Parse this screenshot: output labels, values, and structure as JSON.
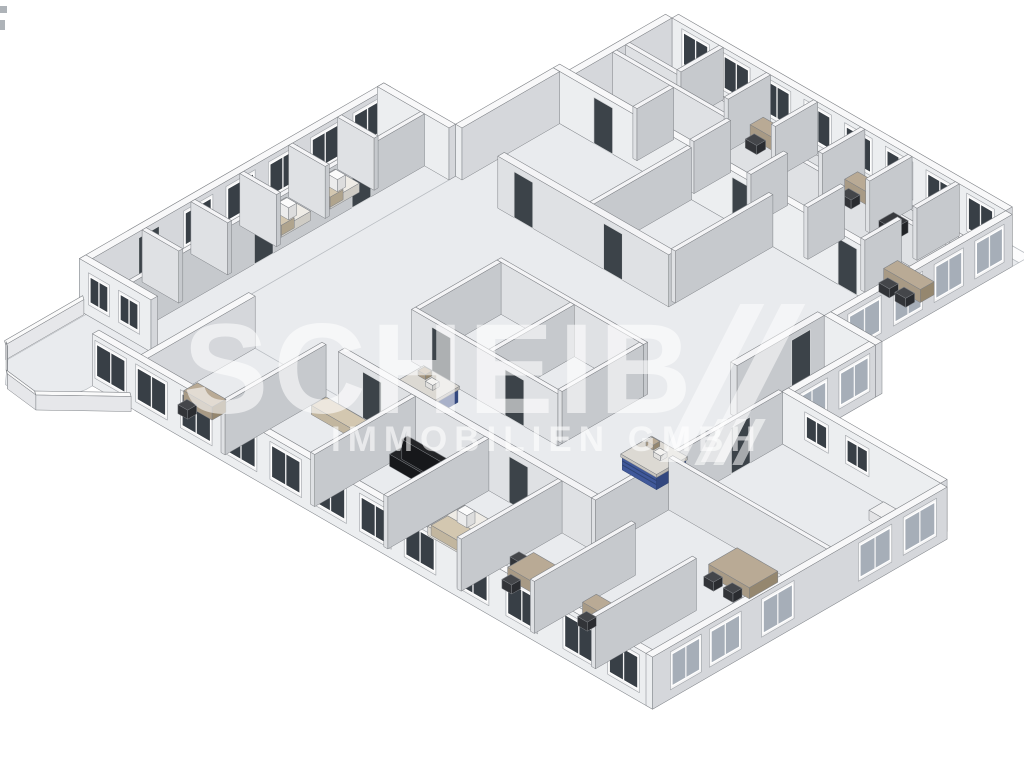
{
  "watermark": {
    "line1": "SCHEIB",
    "line2": "IMMOBILIEN GMBH"
  },
  "palette": {
    "bg": "#ffffff",
    "floor": "#e9ebee",
    "floorStroke": "#b9bdc2",
    "slab": "#fcfcfd",
    "wallTopExt": "#f8f8f9",
    "wallSWExt": "#eceef0",
    "wallSEExt": "#d5d7db",
    "wallTopInt": "#f4f4f6",
    "wallSWInt": "#dfe1e4",
    "wallSEInt": "#c6c9cd",
    "wallStroke": "#7d8085",
    "glassDark": "#383f46",
    "glassLite": "#a6aeb8",
    "frame": "#f4f4f5",
    "frameStroke": "#9fa3a8",
    "door": "#3c4349",
    "doorStroke": "#d7d9db",
    "beigeTop": "#b9aa95",
    "beigeSW": "#a89a85",
    "beigeSE": "#95876f",
    "chairTop": "#44464a",
    "chairSW": "#323438",
    "chairSE": "#2a2c30",
    "whiteTop": "#f1f1f2",
    "whiteSW": "#e4e4e6",
    "whiteSE": "#d6d7da",
    "darkTop": "#37393d",
    "darkSW": "#2a2c30",
    "darkSE": "#222428",
    "sofaTop": "#232427",
    "sofaSW": "#17181b",
    "sofaSE": "#101113",
    "bedTop": "#efece6",
    "bedSW": "#dedbd4",
    "bedSE": "#cfccc5",
    "blanket": "#d3c7b0",
    "blanketSW": "#c2b69f",
    "blanketSE": "#b0a48d",
    "counterTop": "#5e79b2",
    "counterSW": "#40589a",
    "counterSE": "#32477f",
    "counterRib": "#2e4373",
    "plateTop": "#dcd9d3",
    "plateSW": "#c8c5bf",
    "plateSE": "#b9b6b0",
    "parapetTop": "#fafafa",
    "parapetSW": "#e6e7ea",
    "parapetSE": "#d4d6da"
  },
  "scene": {
    "wallHeight": 52,
    "slabs": [
      [
        [
          -6,
          -22
        ],
        [
          418,
          -22
        ],
        [
          418,
          -8
        ],
        [
          -6,
          -8
        ]
      ]
    ],
    "floors": [
      [
        [
          -8,
          -8
        ],
        [
          418,
          -8
        ],
        [
          418,
          126
        ],
        [
          -8,
          126
        ]
      ],
      [
        [
          402,
          126
        ],
        [
          410,
          126
        ],
        [
          410,
          215
        ],
        [
          473,
          215
        ],
        [
          473,
          330
        ],
        [
          402,
          330
        ]
      ],
      [
        [
          -20,
          126
        ],
        [
          402,
          126
        ],
        [
          402,
          330
        ],
        [
          466,
          330
        ],
        [
          466,
          560
        ],
        [
          -20,
          560
        ]
      ],
      [
        [
          -108,
          246
        ],
        [
          -20,
          246
        ],
        [
          -20,
          620
        ],
        [
          -108,
          620
        ]
      ],
      [
        [
          461,
          330
        ],
        [
          668,
          330
        ],
        [
          668,
          692
        ],
        [
          32,
          692
        ],
        [
          32,
          552
        ],
        [
          461,
          552
        ]
      ],
      [
        [
          -100,
          620
        ],
        [
          -20,
          620
        ],
        [
          -20,
          700
        ],
        [
          -30,
          748
        ],
        [
          -75,
          744
        ],
        [
          -100,
          716
        ]
      ]
    ],
    "walls": [
      [
        "e1",
        0,
        -8,
        410,
        0,
        "ext"
      ],
      [
        "e2",
        -8,
        0,
        0,
        126,
        "ext"
      ],
      [
        "e3",
        410,
        0,
        418,
        215,
        "ext"
      ],
      [
        "e4",
        410,
        215,
        473,
        223,
        "ext"
      ],
      [
        "e5",
        465,
        223,
        473,
        330,
        "ext"
      ],
      [
        "e6",
        465,
        322,
        660,
        330,
        "ext"
      ],
      [
        "e7",
        660,
        330,
        668,
        692,
        "ext"
      ],
      [
        "e8",
        -20,
        684,
        668,
        692,
        "ext"
      ],
      [
        "e9",
        32,
        552,
        40,
        692,
        "ext"
      ],
      [
        "e10",
        -108,
        612,
        -20,
        620,
        "ext"
      ],
      [
        "e11",
        -108,
        246,
        -100,
        620,
        "ext"
      ],
      [
        "e12",
        -108,
        246,
        -20,
        254,
        "ext"
      ],
      [
        "e14",
        -20,
        126,
        -12,
        246,
        "ext"
      ],
      [
        "e16",
        -20,
        118,
        410,
        126,
        "ext"
      ],
      [
        "w1",
        0,
        52,
        410,
        57,
        "int"
      ],
      [
        "w2",
        0,
        68,
        410,
        73,
        "int"
      ],
      [
        "w5",
        402,
        223,
        410,
        330,
        "int"
      ],
      [
        "w6a",
        58,
        0,
        63,
        52,
        "int"
      ],
      [
        "w6b",
        116,
        0,
        121,
        52,
        "int"
      ],
      [
        "w6c",
        174,
        0,
        179,
        52,
        "int"
      ],
      [
        "w6d",
        232,
        0,
        237,
        52,
        "int"
      ],
      [
        "w6e",
        290,
        0,
        295,
        52,
        "int"
      ],
      [
        "w6f",
        348,
        0,
        353,
        52,
        "int"
      ],
      [
        "w7a",
        70,
        73,
        75,
        118,
        "int"
      ],
      [
        "w7b",
        140,
        73,
        145,
        118,
        "int"
      ],
      [
        "w7c",
        210,
        73,
        215,
        118,
        "int"
      ],
      [
        "w7d",
        280,
        73,
        285,
        118,
        "int"
      ],
      [
        "w7e",
        350,
        73,
        355,
        118,
        "int"
      ],
      [
        "w21",
        40,
        246,
        250,
        254,
        "int"
      ],
      [
        "w22",
        145,
        126,
        150,
        246,
        "int"
      ],
      [
        "w23",
        245,
        126,
        250,
        246,
        "int"
      ],
      [
        "w8",
        150,
        360,
        330,
        365,
        "int"
      ],
      [
        "w9",
        150,
        465,
        330,
        470,
        "int"
      ],
      [
        "w10",
        150,
        365,
        155,
        465,
        "int"
      ],
      [
        "w11",
        240,
        365,
        245,
        465,
        "int"
      ],
      [
        "w12",
        325,
        365,
        330,
        465,
        "int"
      ],
      [
        "w14",
        -55,
        254,
        -50,
        612,
        "int"
      ],
      [
        "w15a",
        -100,
        306,
        -55,
        311,
        "int"
      ],
      [
        "w15b",
        -100,
        366,
        -55,
        371,
        "int"
      ],
      [
        "w15c",
        -100,
        426,
        -55,
        431,
        "int"
      ],
      [
        "w15d",
        -100,
        486,
        -55,
        491,
        "int"
      ],
      [
        "w15e",
        -100,
        546,
        -55,
        551,
        "int"
      ],
      [
        "w17",
        150,
        552,
        461,
        560,
        "int"
      ],
      [
        "w18",
        461,
        330,
        466,
        560,
        "int"
      ],
      [
        "w19",
        466,
        465,
        660,
        470,
        "int"
      ],
      [
        "w16b",
        130,
        560,
        135,
        684,
        "int"
      ],
      [
        "w16c",
        240,
        560,
        245,
        684,
        "int"
      ],
      [
        "w16d",
        330,
        560,
        335,
        684,
        "int"
      ],
      [
        "w16e",
        420,
        560,
        425,
        684,
        "int"
      ],
      [
        "w16f",
        510,
        560,
        515,
        684,
        "int"
      ],
      [
        "w16g",
        585,
        560,
        590,
        684,
        "int"
      ]
    ],
    "windows": [
      [
        "e1",
        "u",
        0,
        14,
        44,
        12,
        44,
        "dark"
      ],
      [
        "e1",
        "u",
        0,
        64,
        94,
        12,
        44,
        "dark"
      ],
      [
        "e1",
        "u",
        0,
        114,
        144,
        12,
        44,
        "dark"
      ],
      [
        "e1",
        "u",
        0,
        164,
        194,
        12,
        44,
        "dark"
      ],
      [
        "e1",
        "u",
        0,
        214,
        244,
        12,
        44,
        "dark"
      ],
      [
        "e1",
        "u",
        0,
        264,
        294,
        12,
        44,
        "dark"
      ],
      [
        "e1",
        "u",
        0,
        314,
        344,
        12,
        44,
        "dark"
      ],
      [
        "e1",
        "u",
        0,
        364,
        394,
        12,
        44,
        "dark"
      ],
      [
        "e11",
        "v",
        -100,
        258,
        290,
        12,
        44,
        "dark"
      ],
      [
        "e11",
        "v",
        -100,
        310,
        342,
        12,
        44,
        "dark"
      ],
      [
        "e11",
        "v",
        -100,
        362,
        394,
        12,
        44,
        "dark"
      ],
      [
        "e11",
        "v",
        -100,
        414,
        446,
        12,
        44,
        "dark"
      ],
      [
        "e11",
        "v",
        -100,
        466,
        498,
        12,
        44,
        "dark"
      ],
      [
        "e3",
        "v",
        418,
        12,
        44,
        12,
        44,
        "lite"
      ],
      [
        "e3",
        "v",
        418,
        62,
        94,
        12,
        44,
        "lite"
      ],
      [
        "e3",
        "v",
        418,
        112,
        144,
        12,
        44,
        "lite"
      ],
      [
        "e3",
        "v",
        418,
        163,
        200,
        12,
        44,
        "lite"
      ],
      [
        "e5",
        "v",
        473,
        232,
        266,
        12,
        44,
        "lite"
      ],
      [
        "e5",
        "v",
        473,
        284,
        318,
        12,
        44,
        "lite"
      ],
      [
        "e7",
        "v",
        668,
        345,
        382,
        12,
        44,
        "lite"
      ],
      [
        "e7",
        "v",
        668,
        400,
        437,
        12,
        44,
        "lite"
      ],
      [
        "e7",
        "v",
        668,
        520,
        556,
        12,
        44,
        "lite"
      ],
      [
        "e7",
        "v",
        668,
        585,
        620,
        12,
        44,
        "lite"
      ],
      [
        "e7",
        "v",
        668,
        634,
        668,
        12,
        44,
        "lite"
      ],
      [
        "e8",
        "u",
        692,
        -15,
        20,
        12,
        44,
        "dark"
      ],
      [
        "e8",
        "u",
        692,
        35,
        70,
        12,
        44,
        "dark"
      ],
      [
        "e8",
        "u",
        692,
        90,
        125,
        12,
        44,
        "dark"
      ],
      [
        "e8",
        "u",
        692,
        145,
        180,
        12,
        44,
        "dark"
      ],
      [
        "e8",
        "u",
        692,
        200,
        235,
        12,
        44,
        "dark"
      ],
      [
        "e8",
        "u",
        692,
        255,
        290,
        12,
        44,
        "dark"
      ],
      [
        "e8",
        "u",
        692,
        310,
        345,
        12,
        44,
        "dark"
      ],
      [
        "e8",
        "u",
        692,
        365,
        400,
        12,
        44,
        "dark"
      ],
      [
        "e8",
        "u",
        692,
        430,
        465,
        12,
        44,
        "dark"
      ],
      [
        "e8",
        "u",
        692,
        490,
        525,
        12,
        44,
        "dark"
      ],
      [
        "e8",
        "u",
        692,
        560,
        595,
        12,
        44,
        "dark"
      ],
      [
        "e8",
        "u",
        692,
        615,
        650,
        12,
        44,
        "dark"
      ],
      [
        "e10",
        "u",
        620,
        -95,
        -73,
        14,
        40,
        "dark"
      ],
      [
        "e10",
        "u",
        620,
        -58,
        -36,
        14,
        40,
        "dark"
      ],
      [
        "e6",
        "u",
        330,
        495,
        520,
        20,
        42,
        "dark"
      ],
      [
        "e6",
        "u",
        330,
        545,
        570,
        20,
        42,
        "dark"
      ]
    ],
    "doors": [
      [
        "e16",
        "u",
        126,
        30,
        53
      ],
      [
        "e16",
        "u",
        126,
        200,
        223
      ],
      [
        "e16",
        "u",
        126,
        330,
        353
      ],
      [
        "w21",
        "u",
        254,
        60,
        83
      ],
      [
        "w21",
        "u",
        254,
        170,
        193
      ],
      [
        "w9",
        "u",
        470,
        175,
        198
      ],
      [
        "w9",
        "u",
        470,
        265,
        288
      ],
      [
        "w14",
        "v",
        -50,
        320,
        343
      ],
      [
        "w14",
        "v",
        -50,
        440,
        463
      ],
      [
        "w17",
        "u",
        560,
        180,
        203
      ],
      [
        "w17",
        "u",
        560,
        360,
        383
      ],
      [
        "e11",
        "v",
        -100,
        530,
        555
      ],
      [
        "w18",
        "v",
        466,
        370,
        393
      ],
      [
        "w5",
        "v",
        410,
        240,
        263
      ]
    ],
    "furniture": [
      {
        "t": "desk",
        "name": "office-desk",
        "r": [
          120,
          8,
          155,
          24
        ]
      },
      {
        "t": "chair",
        "name": "office-chair",
        "r": [
          128,
          27,
          142,
          38
        ]
      },
      {
        "t": "desk",
        "name": "office-desk",
        "r": [
          236,
          8,
          270,
          24
        ]
      },
      {
        "t": "chair",
        "name": "office-chair",
        "r": [
          244,
          27,
          258,
          38
        ]
      },
      {
        "t": "tableDark",
        "name": "copier-table",
        "r": [
          300,
          28,
          318,
          46
        ]
      },
      {
        "t": "shelf",
        "name": "shelf-cabinet",
        "r": [
          322,
          6,
          342,
          20
        ]
      },
      {
        "t": "desk",
        "name": "corner-office-desk",
        "r": [
          355,
          78,
          400,
          95
        ]
      },
      {
        "t": "chair",
        "name": "office-chair",
        "r": [
          363,
          98,
          376,
          109
        ]
      },
      {
        "t": "chair",
        "name": "office-chair",
        "r": [
          383,
          98,
          396,
          109
        ]
      },
      {
        "t": "sideboard",
        "name": "sideboard",
        "r": [
          430,
          300,
          462,
          318
        ]
      },
      {
        "t": "bed",
        "name": "bed",
        "r": [
          -92,
          262,
          -62,
          298
        ]
      },
      {
        "t": "bed",
        "name": "bed",
        "r": [
          -92,
          322,
          -62,
          358
        ]
      },
      {
        "t": "bed",
        "name": "bed",
        "r": [
          -92,
          382,
          -62,
          418
        ]
      },
      {
        "t": "counter",
        "name": "reception-counter-blue",
        "r": [
          180,
          485,
          222,
          522
        ]
      },
      {
        "t": "counter",
        "name": "reception-counter-blue",
        "r": [
          395,
          420,
          437,
          456
        ]
      },
      {
        "t": "sideboard",
        "name": "sideboard",
        "r": [
          600,
          340,
          640,
          358
        ]
      },
      {
        "t": "table",
        "name": "meeting-table",
        "r": [
          560,
          480,
          610,
          515
        ]
      },
      {
        "t": "chair",
        "name": "chair",
        "r": [
          568,
          518,
          580,
          529
        ]
      },
      {
        "t": "chair",
        "name": "chair",
        "r": [
          592,
          518,
          604,
          529
        ]
      },
      {
        "t": "desk",
        "name": "small-desk",
        "r": [
          55,
          638,
          90,
          655
        ]
      },
      {
        "t": "chair",
        "name": "chair",
        "r": [
          62,
          658,
          74,
          669
        ]
      },
      {
        "t": "bench",
        "name": "bench",
        "r": [
          145,
          570,
          205,
          588
        ]
      },
      {
        "t": "sofa",
        "name": "black-sofa",
        "r": [
          248,
          573,
          298,
          595
        ]
      },
      {
        "t": "bed",
        "name": "bed",
        "r": [
          345,
          600,
          400,
          645
        ]
      },
      {
        "t": "table",
        "name": "table",
        "r": [
          440,
          610,
          475,
          642
        ]
      },
      {
        "t": "chair",
        "name": "chair",
        "r": [
          428,
          616,
          440,
          627
        ]
      },
      {
        "t": "chair",
        "name": "chair",
        "r": [
          447,
          645,
          459,
          656
        ]
      },
      {
        "t": "desk",
        "name": "small-desk",
        "r": [
          525,
          618,
          560,
          635
        ]
      },
      {
        "t": "chair",
        "name": "chair",
        "r": [
          533,
          638,
          545,
          649
        ]
      }
    ],
    "parapets": [
      [
        -106,
        618,
        -106,
        714
      ],
      [
        -104,
        714,
        -74,
        744
      ],
      [
        -74,
        744,
        -34,
        749
      ],
      [
        -34,
        749,
        26,
        692
      ]
    ]
  }
}
